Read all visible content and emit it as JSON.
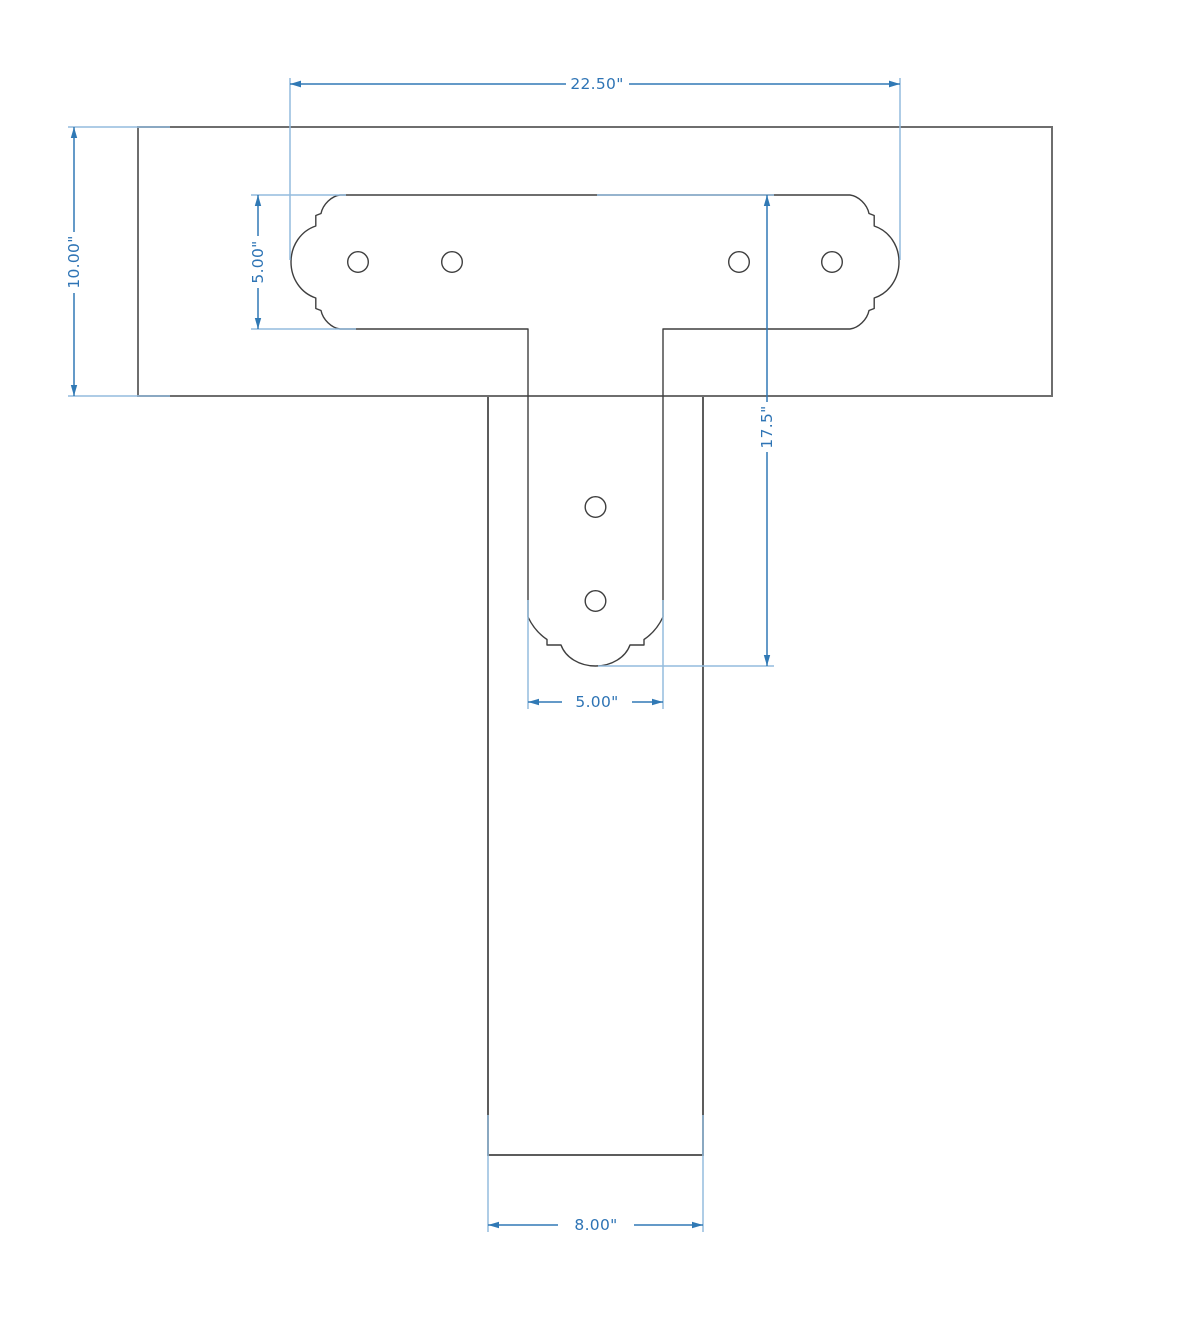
{
  "drawing": {
    "type": "technical-dimension-drawing",
    "subject": "T-bracket post-to-beam connection, front view",
    "background_color": "#ffffff",
    "colors": {
      "structure_line": "#6e6e6e",
      "post_line": "#4a4a4a",
      "bracket_line": "#3f3f3f",
      "extension_line": "#94bcdd",
      "dimension_line": "#3079b5",
      "dimension_text": "#2e74b5"
    },
    "dimensions": {
      "bracket_width": "22.50\"",
      "beam_height": "10.00\"",
      "bracket_arm_height": "5.00\"",
      "bracket_overall_height": "17.5\"",
      "bracket_stem_width": "5.00\"",
      "post_width": "8.00\""
    },
    "bolt_hole_count": 6
  }
}
